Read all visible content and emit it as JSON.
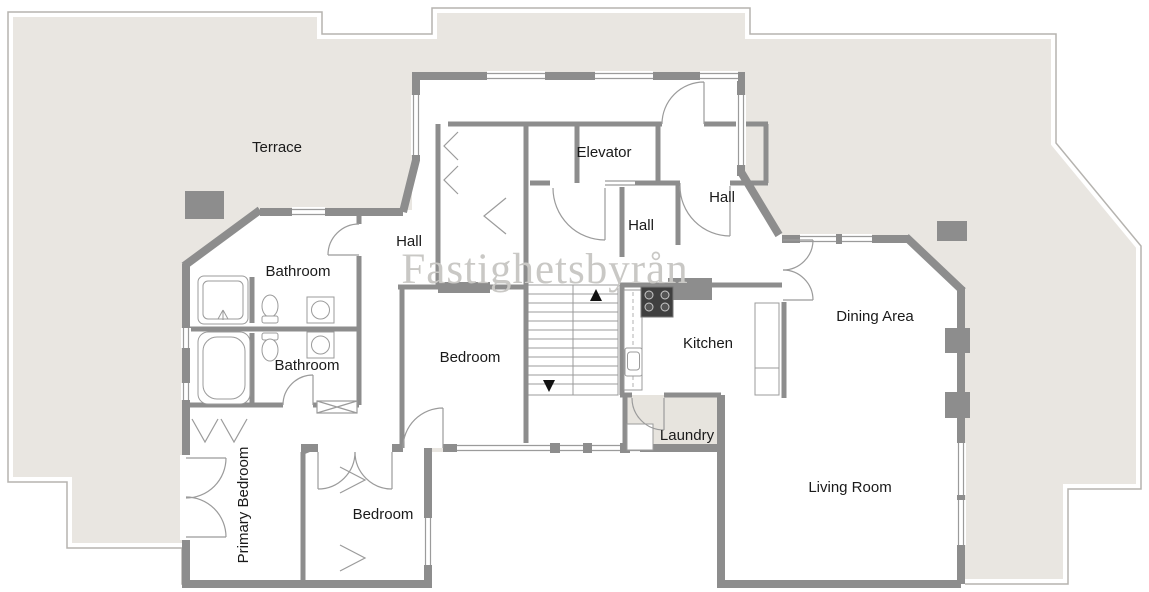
{
  "watermark": {
    "text": "Fastighetsbyrån"
  },
  "rooms": {
    "terrace": {
      "label": "Terrace"
    },
    "elevator": {
      "label": "Elevator"
    },
    "hall_right": {
      "label": "Hall"
    },
    "hall_center": {
      "label": "Hall"
    },
    "hall_left": {
      "label": "Hall"
    },
    "bathroom_top": {
      "label": "Bathroom"
    },
    "bathroom_bottom": {
      "label": "Bathroom"
    },
    "bedroom_center": {
      "label": "Bedroom"
    },
    "kitchen": {
      "label": "Kitchen"
    },
    "dining": {
      "label": "Dining Area"
    },
    "laundry": {
      "label": "Laundry"
    },
    "living": {
      "label": "Living Room"
    },
    "primary_bedroom": {
      "label": "Primary Bedroom"
    },
    "bedroom_bottom": {
      "label": "Bedroom"
    }
  },
  "colors": {
    "terrace_fill": "#e9e6e1",
    "room_fill": "#ffffff",
    "wall": "#8d8d8d",
    "outline": "#b5b3af",
    "thin_line": "#9b9b9b",
    "label_text": "#1a1a1a",
    "watermark": "#c9c8c5",
    "laundry_floor": "#e7e4de",
    "stove": "#3f3f3f",
    "stair_arrow": "#111111"
  },
  "fixtures": {
    "names": [
      "shower",
      "bathtub",
      "toilet",
      "sink",
      "stove",
      "kitchen-counter",
      "staircase",
      "stair-up-arrow",
      "stair-down-arrow",
      "elevator-door",
      "wardrobe",
      "door-swing",
      "french-doors",
      "window",
      "chimney-pillar"
    ]
  }
}
